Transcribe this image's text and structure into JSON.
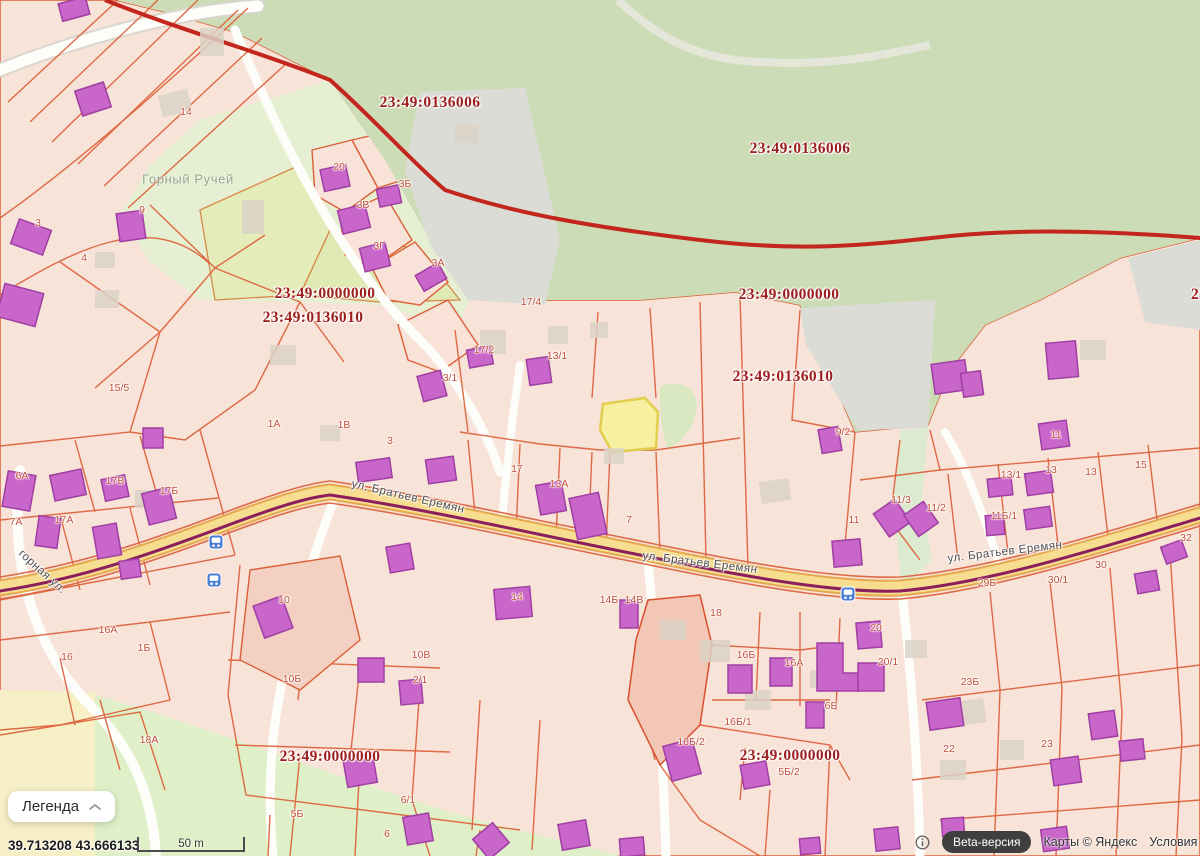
{
  "map": {
    "cadastral_labels": [
      {
        "text": "23:49:0136006",
        "x": 430,
        "y": 103
      },
      {
        "text": "23:49:0136006",
        "x": 800,
        "y": 149
      },
      {
        "text": "23:49:0000000",
        "x": 325,
        "y": 294
      },
      {
        "text": "23:49:0136010",
        "x": 313,
        "y": 318
      },
      {
        "text": "23:49:0000000",
        "x": 789,
        "y": 295
      },
      {
        "text": "23:49:0136010",
        "x": 783,
        "y": 377
      },
      {
        "text": "23:4",
        "x": 1206,
        "y": 295
      },
      {
        "text": "23:49:0000000",
        "x": 330,
        "y": 757
      },
      {
        "text": "23:49:0000000",
        "x": 790,
        "y": 756
      }
    ],
    "street_labels": [
      {
        "text": "ул. Братьев Еремян",
        "x": 408,
        "y": 497,
        "rot": 13
      },
      {
        "text": "ул. Братьев Еремян",
        "x": 700,
        "y": 563,
        "rot": 7
      },
      {
        "text": "ул. Братьев Еремян",
        "x": 1005,
        "y": 552,
        "rot": -7
      },
      {
        "text": "горная ул.",
        "x": 42,
        "y": 572,
        "rot": 42
      }
    ],
    "place_labels": [
      {
        "text": "Горный Ручей",
        "x": 188,
        "y": 179
      }
    ],
    "parcel_numbers": [
      {
        "text": "14",
        "x": 186,
        "y": 112
      },
      {
        "text": "9",
        "x": 142,
        "y": 210
      },
      {
        "text": "3",
        "x": 38,
        "y": 223
      },
      {
        "text": "4",
        "x": 84,
        "y": 258
      },
      {
        "text": "20",
        "x": 339,
        "y": 167
      },
      {
        "text": "3Б",
        "x": 405,
        "y": 184
      },
      {
        "text": "3В",
        "x": 363,
        "y": 205
      },
      {
        "text": "3Г",
        "x": 379,
        "y": 246
      },
      {
        "text": "3А",
        "x": 438,
        "y": 263
      },
      {
        "text": "15/5",
        "x": 119,
        "y": 388
      },
      {
        "text": "1А",
        "x": 274,
        "y": 424
      },
      {
        "text": "1В",
        "x": 344,
        "y": 425
      },
      {
        "text": "3",
        "x": 390,
        "y": 441
      },
      {
        "text": "3/1",
        "x": 450,
        "y": 378
      },
      {
        "text": "17/4",
        "x": 531,
        "y": 302
      },
      {
        "text": "17/2",
        "x": 484,
        "y": 350
      },
      {
        "text": "13/1",
        "x": 557,
        "y": 356
      },
      {
        "text": "17",
        "x": 517,
        "y": 469
      },
      {
        "text": "13А",
        "x": 559,
        "y": 484
      },
      {
        "text": "7",
        "x": 629,
        "y": 520
      },
      {
        "text": "6А",
        "x": 22,
        "y": 476
      },
      {
        "text": "17В",
        "x": 115,
        "y": 481
      },
      {
        "text": "17Б",
        "x": 169,
        "y": 491
      },
      {
        "text": "17А",
        "x": 64,
        "y": 520
      },
      {
        "text": "7А",
        "x": 16,
        "y": 522
      },
      {
        "text": "16А",
        "x": 108,
        "y": 630
      },
      {
        "text": "1Б",
        "x": 144,
        "y": 648
      },
      {
        "text": "16",
        "x": 67,
        "y": 657
      },
      {
        "text": "18А",
        "x": 149,
        "y": 740
      },
      {
        "text": "10",
        "x": 284,
        "y": 600
      },
      {
        "text": "10Б",
        "x": 292,
        "y": 679
      },
      {
        "text": "10В",
        "x": 421,
        "y": 655
      },
      {
        "text": "2/1",
        "x": 420,
        "y": 680
      },
      {
        "text": "5Б",
        "x": 297,
        "y": 814
      },
      {
        "text": "6/1",
        "x": 408,
        "y": 800
      },
      {
        "text": "6",
        "x": 387,
        "y": 834
      },
      {
        "text": "14",
        "x": 517,
        "y": 597
      },
      {
        "text": "14Б",
        "x": 609,
        "y": 600
      },
      {
        "text": "14В",
        "x": 634,
        "y": 600
      },
      {
        "text": "18",
        "x": 716,
        "y": 613
      },
      {
        "text": "16Б",
        "x": 746,
        "y": 655
      },
      {
        "text": "16А",
        "x": 794,
        "y": 663
      },
      {
        "text": "20",
        "x": 876,
        "y": 628
      },
      {
        "text": "20/1",
        "x": 888,
        "y": 662
      },
      {
        "text": "6Б",
        "x": 831,
        "y": 706
      },
      {
        "text": "16Б/1",
        "x": 738,
        "y": 722
      },
      {
        "text": "16Б/2",
        "x": 691,
        "y": 742
      },
      {
        "text": "5Б/2",
        "x": 789,
        "y": 772
      },
      {
        "text": "9/2",
        "x": 843,
        "y": 432
      },
      {
        "text": "11/3",
        "x": 901,
        "y": 500
      },
      {
        "text": "11/2",
        "x": 936,
        "y": 508
      },
      {
        "text": "11",
        "x": 854,
        "y": 520
      },
      {
        "text": "11",
        "x": 1056,
        "y": 435
      },
      {
        "text": "13/1",
        "x": 1011,
        "y": 475
      },
      {
        "text": "13",
        "x": 1051,
        "y": 470
      },
      {
        "text": "13",
        "x": 1091,
        "y": 472
      },
      {
        "text": "15",
        "x": 1141,
        "y": 465
      },
      {
        "text": "11Б/1",
        "x": 1004,
        "y": 516
      },
      {
        "text": "32",
        "x": 1186,
        "y": 538
      },
      {
        "text": "30",
        "x": 1101,
        "y": 565
      },
      {
        "text": "30/1",
        "x": 1058,
        "y": 580
      },
      {
        "text": "29Б",
        "x": 987,
        "y": 583
      },
      {
        "text": "23Б",
        "x": 970,
        "y": 682
      },
      {
        "text": "22",
        "x": 949,
        "y": 749
      },
      {
        "text": "23",
        "x": 1047,
        "y": 744
      }
    ],
    "bus_stops": [
      {
        "x": 216,
        "y": 542
      },
      {
        "x": 214,
        "y": 580
      },
      {
        "x": 848,
        "y": 594
      }
    ],
    "selected_parcel_fill": "#f6f0a0"
  },
  "legend": {
    "label": "Легенда"
  },
  "status_bar": {
    "coordinates": "39.713208  43.666133",
    "scale": "50 m"
  },
  "attribution": {
    "beta": "Beta-версия",
    "copyright": "Карты © Яндекс",
    "terms": "Условия использ"
  },
  "colors": {
    "parcel_fill": "#f8e3d8",
    "parcel_border": "#dc5f38",
    "building": "#c966c9",
    "building_border": "#9f3fa3",
    "forest": "#ccdcb6",
    "road_yellow": "#f5dc8e",
    "red_line": "#c3261d",
    "road_center_line": "#8a1f5c",
    "cadastral_text": "#9c1d1d",
    "selected_parcel": "#f6f0a0",
    "beta_badge_bg": "#3f3f3f",
    "bus_icon": "#4a7cd6"
  }
}
